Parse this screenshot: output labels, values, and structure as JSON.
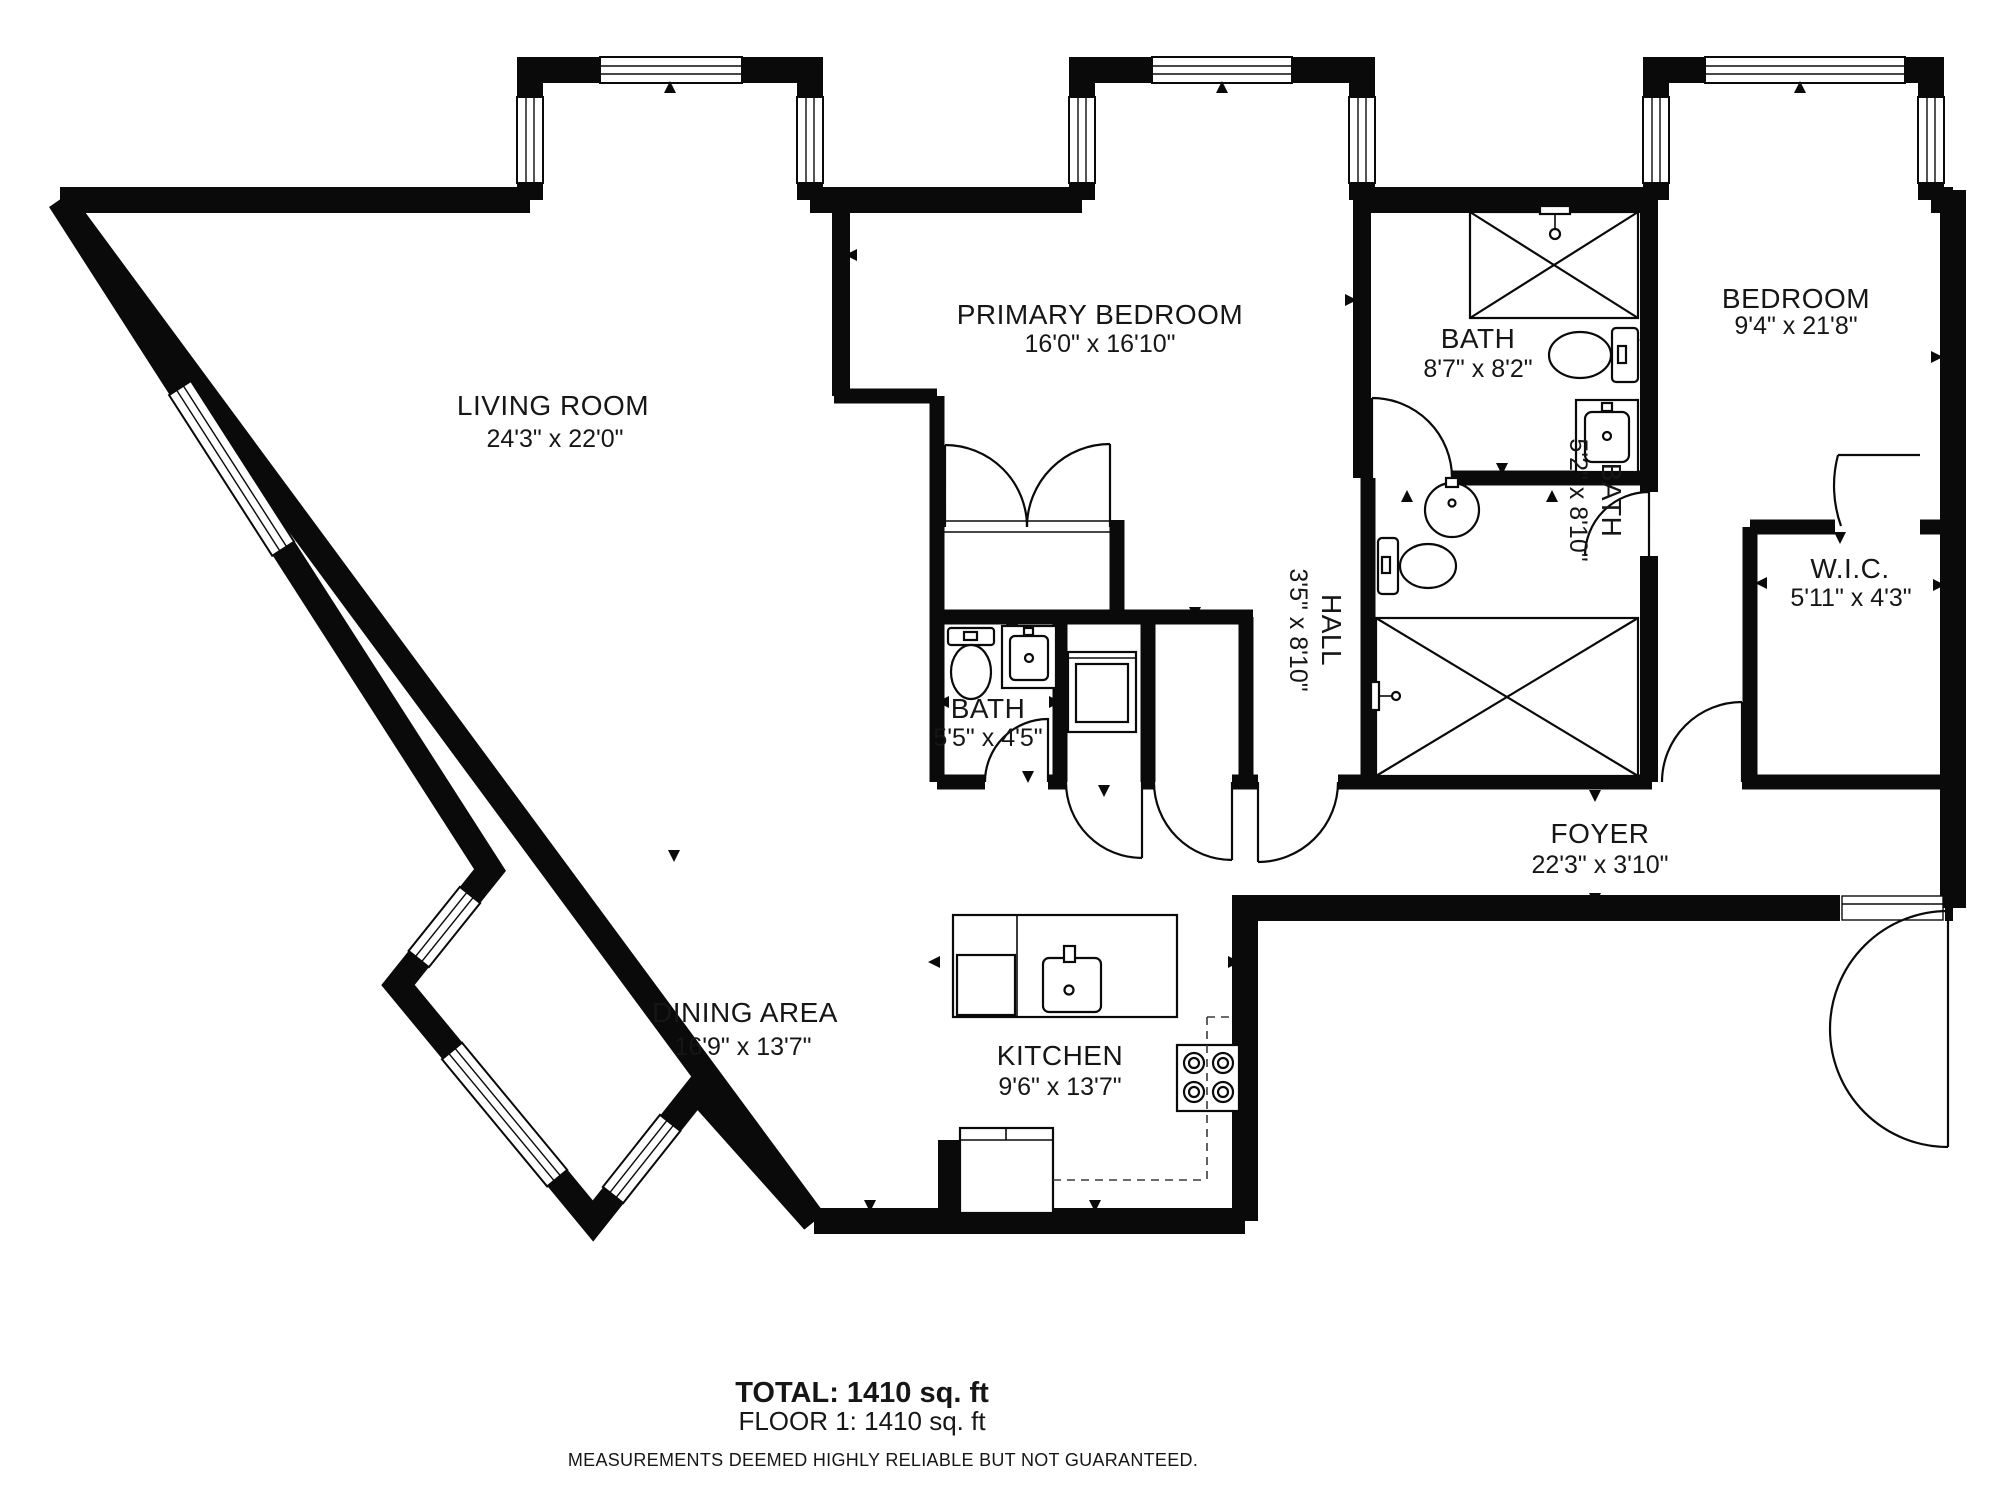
{
  "floor_plan": {
    "rooms": [
      {
        "id": "living",
        "name": "LIVING ROOM",
        "dims": "24'3\" x 22'0\""
      },
      {
        "id": "primary",
        "name": "PRIMARY BEDROOM",
        "dims": "16'0\" x 16'10\""
      },
      {
        "id": "bath_top",
        "name": "BATH",
        "dims": "8'7\" x 8'2\""
      },
      {
        "id": "bedroom",
        "name": "BEDROOM",
        "dims": "9'4\" x 21'8\""
      },
      {
        "id": "hall",
        "name": "HALL",
        "dims": "3'5\" x 8'10\""
      },
      {
        "id": "bath_mid",
        "name": "BATH",
        "dims": "5'2\" x 8'10\""
      },
      {
        "id": "wic",
        "name": "W.I.C.",
        "dims": "5'11\" x 4'3\""
      },
      {
        "id": "bath_small",
        "name": "BATH",
        "dims": "5'5\" x 4'5\""
      },
      {
        "id": "foyer",
        "name": "FOYER",
        "dims": "22'3\" x 3'10\""
      },
      {
        "id": "dining",
        "name": "DINING AREA",
        "dims": "16'9\" x 13'7\""
      },
      {
        "id": "kitchen",
        "name": "KITCHEN",
        "dims": "9'6\" x 13'7\""
      }
    ],
    "summary": {
      "total": "TOTAL: 1410 sq. ft",
      "floor": "FLOOR 1: 1410 sq. ft",
      "disclaimer": "MEASUREMENTS DEEMED HIGHLY RELIABLE BUT NOT GUARANTEED."
    },
    "fixtures": [
      {
        "name": "shower",
        "room": "bath_top"
      },
      {
        "name": "toilet",
        "room": "bath_top"
      },
      {
        "name": "vanity-sink",
        "room": "bath_top"
      },
      {
        "name": "pedestal-sink",
        "room": "bath_mid"
      },
      {
        "name": "toilet",
        "room": "bath_mid"
      },
      {
        "name": "shower",
        "room": "bath_mid"
      },
      {
        "name": "toilet",
        "room": "bath_small"
      },
      {
        "name": "vanity-sink",
        "room": "bath_small"
      },
      {
        "name": "washer",
        "room": "closet"
      },
      {
        "name": "double-door-closet",
        "room": "primary"
      },
      {
        "name": "kitchen-sink",
        "room": "kitchen"
      },
      {
        "name": "dishwasher",
        "room": "kitchen"
      },
      {
        "name": "cooktop",
        "room": "kitchen"
      },
      {
        "name": "base-cabinets",
        "room": "kitchen"
      },
      {
        "name": "entry-double-door",
        "room": "foyer"
      }
    ],
    "colors": {
      "wall": "#0a0a0a",
      "floor": "#ffffff",
      "text": "#161616"
    }
  }
}
